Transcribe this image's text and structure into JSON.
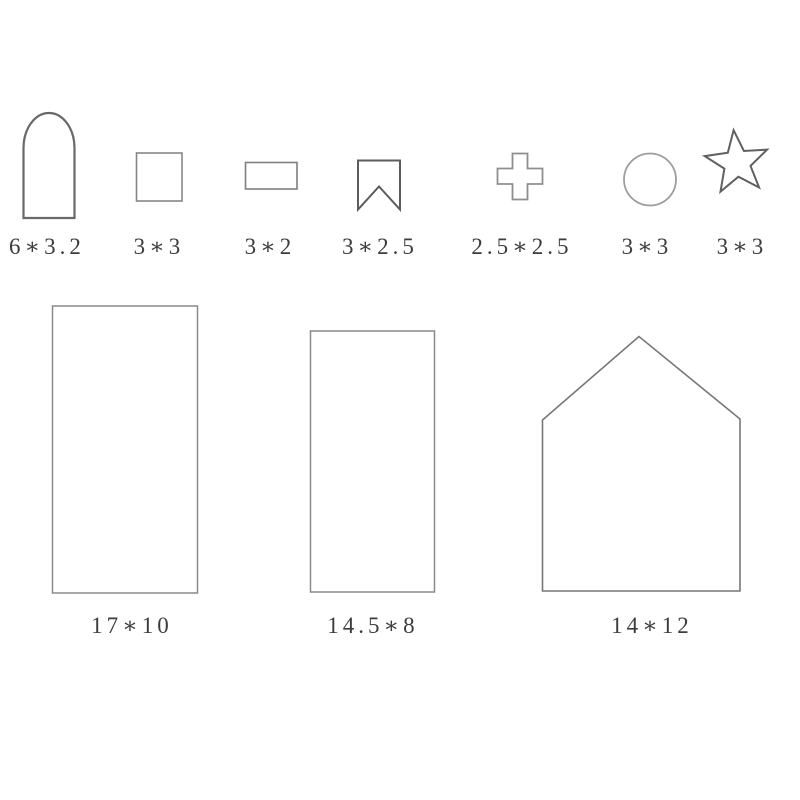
{
  "diagram": {
    "description_labels_visible_only": true,
    "small_shapes": [
      {
        "shape": "arch",
        "size_label": "6*3.2"
      },
      {
        "shape": "square",
        "size_label": "3*3"
      },
      {
        "shape": "rectangle",
        "size_label": "3*2"
      },
      {
        "shape": "banner",
        "size_label": "3*2.5"
      },
      {
        "shape": "cross",
        "size_label": "2.5*2.5"
      },
      {
        "shape": "circle",
        "size_label": "3*3"
      },
      {
        "shape": "star",
        "size_label": "3*3"
      }
    ],
    "large_shapes": [
      {
        "shape": "tall-rectangle",
        "size_label": "17*10"
      },
      {
        "shape": "tall-rectangle",
        "size_label": "14.5*8"
      },
      {
        "shape": "house",
        "size_label": "14*12"
      }
    ]
  },
  "colors": {
    "background": "#ffffff",
    "outline_dark": "#5f5f5f",
    "outline_mid": "#7d7d7d",
    "outline_light": "#9d9d9d",
    "label_text": "#3c3c3c"
  }
}
